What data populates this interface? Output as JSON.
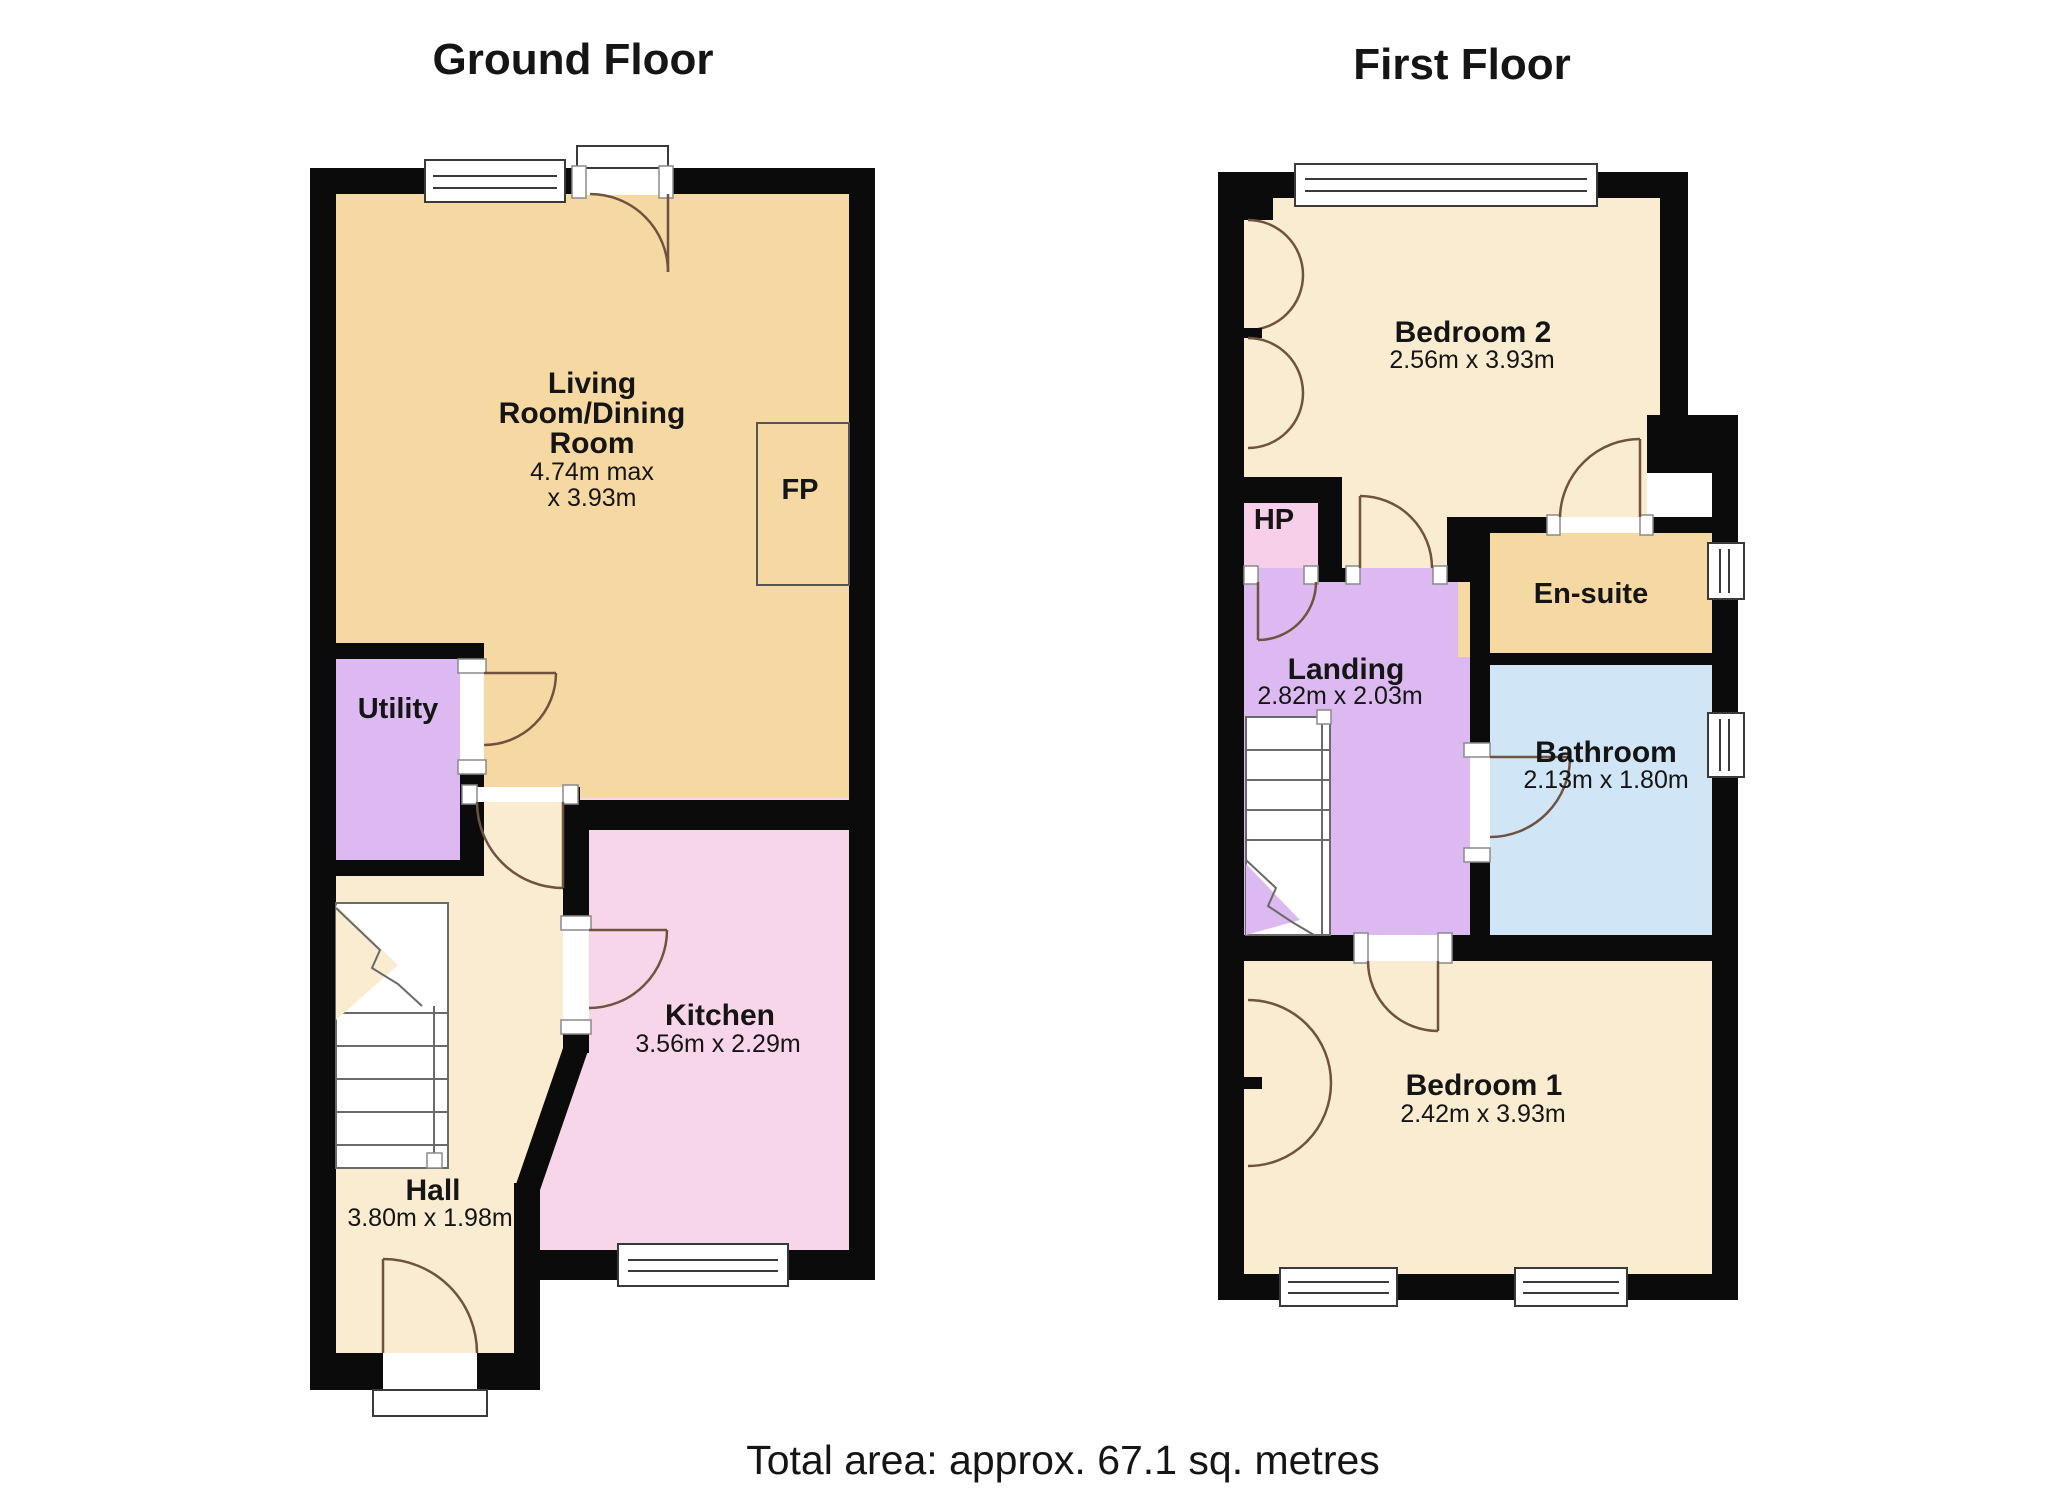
{
  "ground": {
    "title": "Ground Floor",
    "living_room": {
      "line1": "Living",
      "line2": "Room/Dining",
      "line3": "Room",
      "dim1": "4.74m max",
      "dim2": "x 3.93m"
    },
    "fireplace": "FP",
    "utility": "Utility",
    "kitchen": {
      "name": "Kitchen",
      "dims": "3.56m x 2.29m"
    },
    "hall": {
      "name": "Hall",
      "dims": "3.80m x 1.98m"
    }
  },
  "first": {
    "title": "First Floor",
    "bedroom2": {
      "name": "Bedroom 2",
      "dims": "2.56m x 3.93m"
    },
    "hp": "HP",
    "landing": {
      "name": "Landing",
      "dims": "2.82m x 2.03m"
    },
    "ensuite": "En-suite",
    "bathroom": {
      "name": "Bathroom",
      "dims": "2.13m x 1.80m"
    },
    "bedroom1": {
      "name": "Bedroom 1",
      "dims": "2.42m x 3.93m"
    }
  },
  "footer": {
    "total_area": "Total area: approx. 67.1 sq. metres"
  },
  "colors": {
    "wall": "#0b0b0b",
    "living_tan": "#f6d8a3",
    "hall_bedroom_cream": "#faecd0",
    "kitchen_pink": "#f8d6ea",
    "utility_landing_purple": "#dcbaf1",
    "hp_pink": "#f7cfe9",
    "bathroom_blue": "#d0e5f6"
  }
}
